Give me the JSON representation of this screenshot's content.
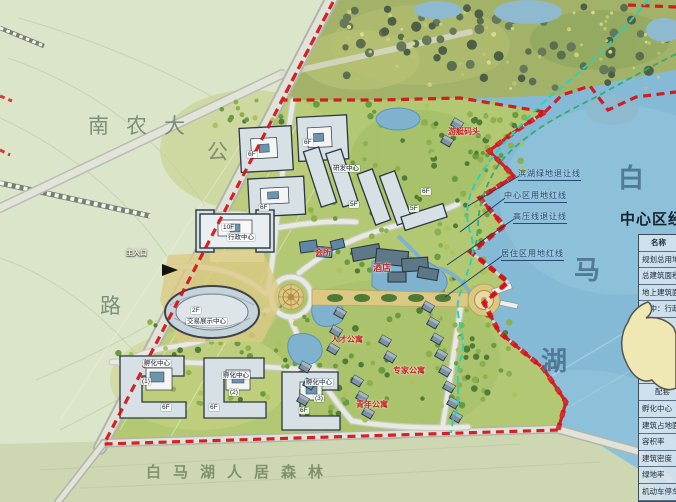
{
  "labels": {
    "campus": "南农大",
    "road_top": "公",
    "road_bottom": "路",
    "forest_band": "白马湖人居森林",
    "lake": [
      "白",
      "马",
      "湖"
    ],
    "entrance": "主入口"
  },
  "boundary_lines": [
    {
      "text": "滨湖绿地退让线"
    },
    {
      "text": "中心区用地红线"
    },
    {
      "text": "高压线退让线"
    },
    {
      "text": "居住区用地红线"
    }
  ],
  "red_labels": [
    {
      "text": "游艇码头"
    },
    {
      "text": "会所"
    },
    {
      "text": "酒店"
    },
    {
      "text": "人才公寓"
    },
    {
      "text": "专家公寓"
    },
    {
      "text": "青年公寓"
    }
  ],
  "building_labels": [
    {
      "text": "6F"
    },
    {
      "text": "6F"
    },
    {
      "text": "6F"
    },
    {
      "text": "研发中心"
    },
    {
      "text": "5F"
    },
    {
      "text": "5F"
    },
    {
      "text": "6F"
    },
    {
      "text": "10F"
    },
    {
      "text": "行政中心"
    },
    {
      "text": "2F"
    },
    {
      "text": "交易展示中心"
    },
    {
      "text": "孵化中心"
    },
    {
      "text": "(1)"
    },
    {
      "text": "6F"
    },
    {
      "text": "孵化中心"
    },
    {
      "text": "(2)"
    },
    {
      "text": "6F"
    },
    {
      "text": "孵化中心"
    },
    {
      "text": "(3)"
    },
    {
      "text": "6F"
    }
  ],
  "legend_table": {
    "title": "中心区经济技术指标",
    "rows": [
      "名称",
      "规划总用地",
      "总建筑面积",
      "地上建筑面积",
      "其中：行政中心",
      "酒店",
      "交易展示中心",
      "研发中心",
      "商业",
      "配套",
      "孵化中心",
      "建筑占地面积",
      "容积率",
      "建筑密度",
      "绿地率",
      "机动车停车位"
    ]
  },
  "colors": {
    "boundary_red": "#d21015",
    "setback_cyan": "#25d3bd",
    "setback_green": "#2fae6e",
    "lake_blue": "#85bad6"
  }
}
